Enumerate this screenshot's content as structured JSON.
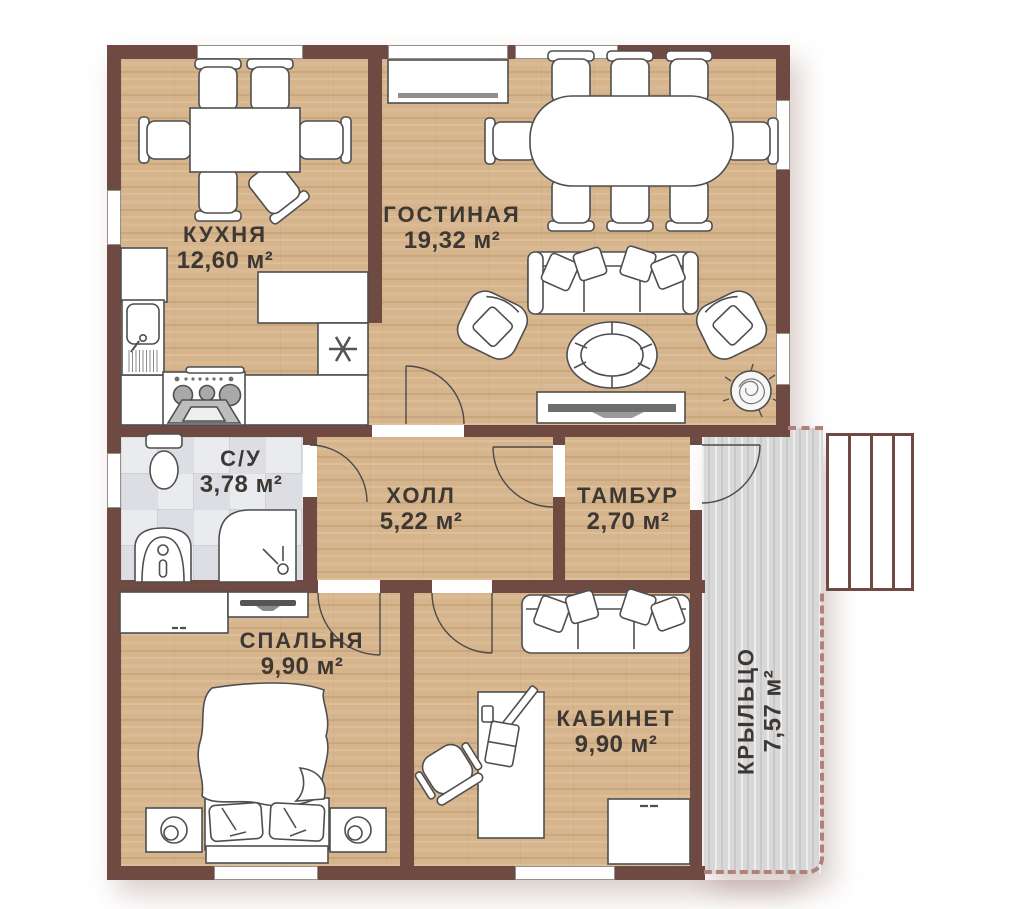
{
  "rooms": {
    "kitchen": {
      "name": "КУХНЯ",
      "area": "12,60 м²"
    },
    "living_room": {
      "name": "ГОСТИНАЯ",
      "area": "19,32 м²"
    },
    "bathroom": {
      "name": "С/У",
      "area": "3,78 м²"
    },
    "hall": {
      "name": "ХОЛЛ",
      "area": "5,22 м²"
    },
    "vestibule": {
      "name": "ТАМБУР",
      "area": "2,70 м²"
    },
    "bedroom": {
      "name": "СПАЛЬНЯ",
      "area": "9,90 м²"
    },
    "office": {
      "name": "КАБИНЕТ",
      "area": "9,90 м²"
    },
    "porch": {
      "name": "КРЫЛЬЦО",
      "area": "7,57 м²"
    }
  },
  "porch_details": {
    "stairs_steps": 4
  },
  "icons": {
    "kitchen_freezer_symbol": "asterisk-icon",
    "plant": "plant-icon"
  },
  "colors": {
    "wall": "#6e4a43",
    "wood_floor": "#d7b58c",
    "tile_floor": "#e9ebee",
    "porch_deck": "#d8d8d8",
    "porch_dash": "#b28079",
    "furniture_outline": "#4f4f4f",
    "label_text": "#3e3835"
  }
}
